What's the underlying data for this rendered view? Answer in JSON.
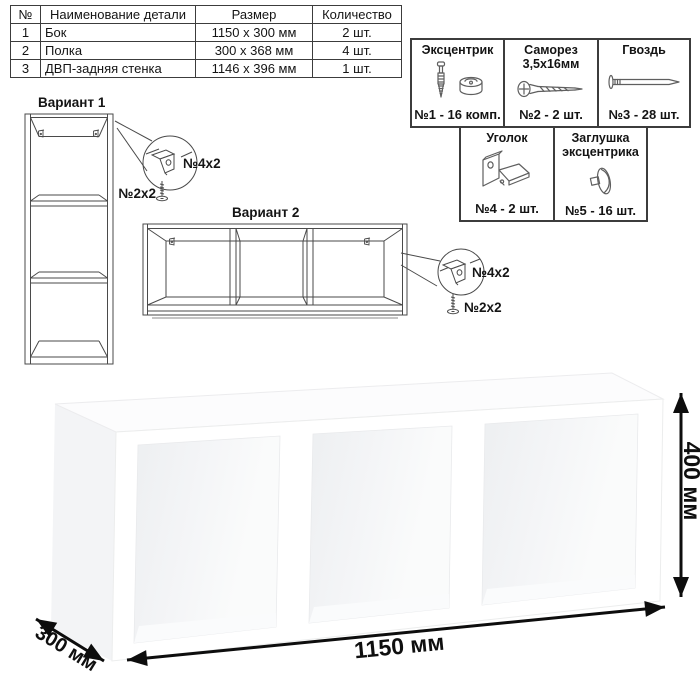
{
  "parts_table": {
    "headers": [
      "№",
      "Наименование детали",
      "Размер",
      "Количество"
    ],
    "rows": [
      {
        "num": "1",
        "name": "Бок",
        "size": "1150 х 300 мм",
        "qty": "2 шт."
      },
      {
        "num": "2",
        "name": "Полка",
        "size": "300 х 368 мм",
        "qty": "4 шт."
      },
      {
        "num": "3",
        "name": "ДВП-задняя стенка",
        "size": "1146 х 396 мм",
        "qty": "1 шт."
      }
    ]
  },
  "hardware": {
    "items": [
      {
        "title": "Эксцентрик",
        "count": "№1 - 16 комп."
      },
      {
        "title": "Саморез 3,5х16мм",
        "count": "№2 - 2 шт."
      },
      {
        "title": "Гвоздь",
        "count": "№3 - 28 шт."
      },
      {
        "title": "Уголок",
        "count": "№4 - 2 шт."
      },
      {
        "title": "Заглушка эксцентрика",
        "count": "№5 - 16 шт."
      }
    ]
  },
  "variants": {
    "v1": {
      "title": "Вариант 1",
      "bracket_label": "№4х2",
      "screw_label": "№2х2"
    },
    "v2": {
      "title": "Вариант 2",
      "bracket_label": "№4х2",
      "screw_label": "№2х2"
    }
  },
  "dimensions": {
    "width": "1150 мм",
    "depth": "300 мм",
    "height": "400 мм"
  },
  "colors": {
    "line": "#4a4a4a",
    "text": "#141414",
    "arrow": "#0d0d0d"
  }
}
